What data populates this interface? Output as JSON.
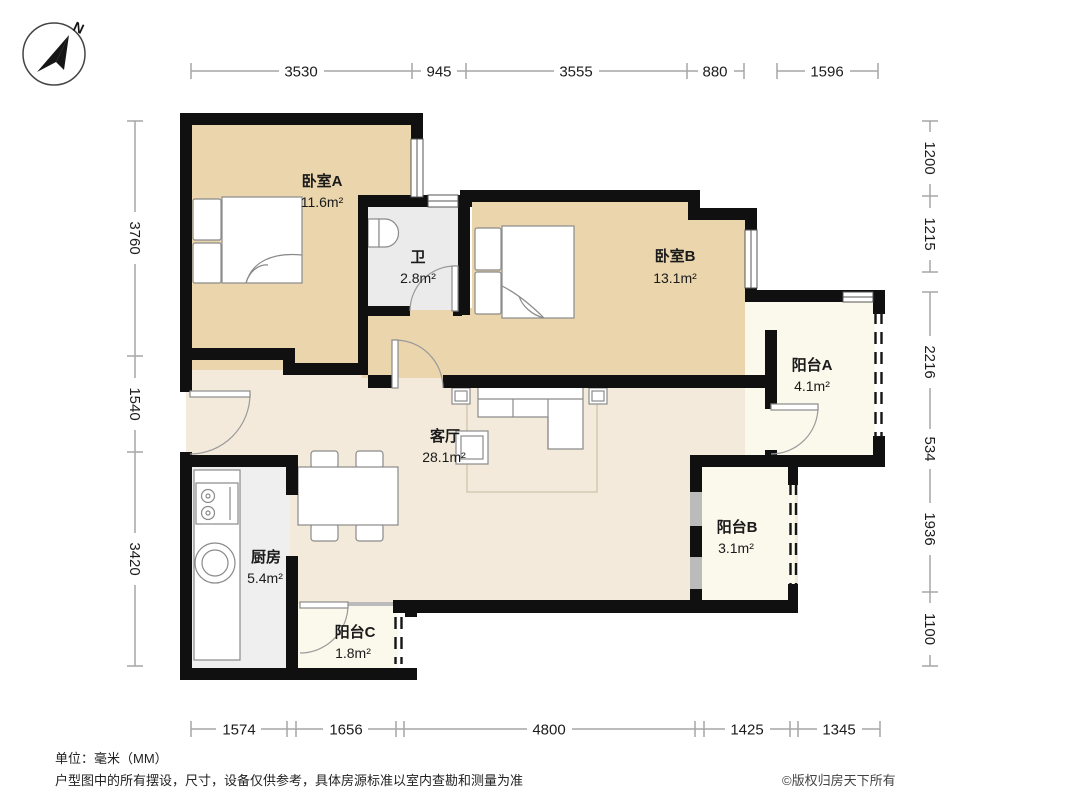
{
  "compass": {
    "north_label": "N"
  },
  "rooms": [
    {
      "name": "卧室A",
      "area": "11.6m²"
    },
    {
      "name": "卫",
      "area": "2.8m²"
    },
    {
      "name": "卧室B",
      "area": "13.1m²"
    },
    {
      "name": "阳台A",
      "area": "4.1m²"
    },
    {
      "name": "客厅",
      "area": "28.1m²"
    },
    {
      "name": "阳台B",
      "area": "3.1m²"
    },
    {
      "name": "厨房",
      "area": "5.4m²"
    },
    {
      "name": "阳台C",
      "area": "1.8m²"
    }
  ],
  "dimensions": {
    "top": [
      "3530",
      "945",
      "3555",
      "880",
      "1596"
    ],
    "left": [
      "3760",
      "1540",
      "3420"
    ],
    "right": [
      "1200",
      "1215",
      "2216",
      "534",
      "1936",
      "1100"
    ],
    "bottom": [
      "1574",
      "1656",
      "4800",
      "1425",
      "1345"
    ]
  },
  "footer": {
    "unit_note": "单位：毫米（MM）",
    "disclaimer": "户型图中的所有摆设，尺寸，设备仅供参考，具体房源标准以室内查勘和测量为准",
    "copyright": "©版权归房天下所有"
  },
  "colors": {
    "wall": "#101010",
    "bedroom_fill": "#ead5ac",
    "living_fill": "#f3eadb",
    "wet_fill": "#ebebeb",
    "balcony_fill": "#fbf9ec",
    "dimension_line": "#a6a6a6"
  }
}
